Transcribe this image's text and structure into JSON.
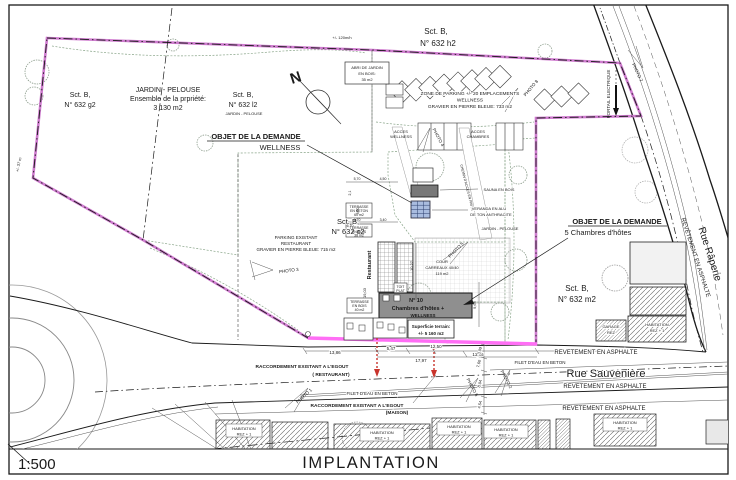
{
  "meta": {
    "scale": "1:500",
    "title": "IMPLANTATION"
  },
  "colors": {
    "green": "#d8edd4",
    "magenta_boundary": "#cf7bcf",
    "magenta_bright": "#ff6ef5",
    "red_sewer": "#c9342c",
    "veranda_blue": "#a9bcdf",
    "building_gray": "#8f8f8f"
  },
  "compass": {
    "north": "N"
  },
  "parcels": {
    "sct": "Sct. B,",
    "g2": "N° 632 g2",
    "l2": "N° 632 l2",
    "l2_type": "JARDIN - PELOUSE",
    "h2": "N° 632 h2",
    "c2": "N° 632 c2",
    "m2": "N° 632 m2"
  },
  "garden": {
    "l1": "JARDIN - PELOUSE",
    "l2": "Ensemble de la prpriété:",
    "l3": "3 130 m2",
    "length_note": "+/- 120m/h",
    "width_note": "+/- 37 m"
  },
  "abri": {
    "l1": "ABRI DE JARDIN",
    "l2": "EN BOIS:",
    "l3": "35 m2"
  },
  "parking_wellness": {
    "l1": "ZONE DE PARKING +/- 20 EMPLACEMENTS",
    "l2": "WELLNESS",
    "l3": "GRAVIER EN PIERRE BLEUE: 733 m2"
  },
  "parking_restaurant": {
    "l1": "PARKING EXISTANT",
    "l2": "RESTAURANT",
    "l3": "GRAVIER EN PIERRE BLEUE: 715 m2"
  },
  "objet_wellness": {
    "l1": "OBJET DE LA DEMANDE",
    "l2": "WELLNESS"
  },
  "objet_chambres": {
    "l1": "OBJET DE LA DEMANDE",
    "l2": "5 Chambres d'hôtes"
  },
  "access": {
    "acces": "ACCES",
    "wellness": "WELLNESS",
    "chambres": "CHAMBRES"
  },
  "features": {
    "portail": "PORTAIL ELECTRIQUE",
    "chemin": "CHEMIN D'ACCES EN PAVES",
    "sauna": "SAUNA EN BOIS",
    "veranda_l1": "VERANDA EN ALU",
    "veranda_l2": "DE TON ANTHRACITE",
    "jardin": "JARDIN - PELOUSE",
    "cour_l1": "COUR",
    "cour_l2": "CARREAUX 40/40",
    "cour_l3": "119 m2",
    "toit_l1": "TOIT",
    "toit_l2": "PLAT",
    "restaurant": "Restaurant"
  },
  "building": {
    "n10": "N° 10",
    "name": "Chambres d'hôtes +",
    "suffix": "WELLNESS",
    "sup_l1": "Superficie terrain:",
    "sup_l2": "+/- 5 160 m2"
  },
  "terraces": {
    "terrasse": "TERRASSE",
    "beton": "EN BETON",
    "bois": "EN BOIS",
    "a60": "60 m2",
    "a38": "38 m2",
    "a40": "40 m2"
  },
  "roads": {
    "sauveniere": "Rue Sauvenière",
    "raperie": "Rue Râperie",
    "revetement": "REVETEMENT EN ASPHALTE",
    "revetement_v": "REVÊTEMENT EN ASPHALTE",
    "filet": "FILET D'EAU EN BETON"
  },
  "sewer": {
    "l1": "RACCORDEMENT EXISTANT A L'EGOUT",
    "restaurant": "( RESTAURANT)",
    "maison": "(MAISON)"
  },
  "houses": {
    "habitation": "HABITATION",
    "rez1": "REZ + 1",
    "garage": "GARAGE",
    "rez": "REZ"
  },
  "photos": {
    "p1": "PHOTO 1",
    "p2": "PHOTO 2",
    "p3": "PHOTO 3",
    "p4": "PHOTO 4",
    "p5": "PHOTO 5",
    "p6": "PHOTO 6",
    "p7": "PHOTO 7",
    "p8": "PHOTO 8"
  },
  "dims": {
    "d1386": "13,86",
    "d547": "5,47",
    "d1250": "12,50",
    "d1797": "17,97",
    "d1305": "13,05",
    "d309": "3,09",
    "d760": "7,60",
    "d804": "8,04",
    "d454": "4,54",
    "d1027": "10,27",
    "d965": "9,65",
    "d1903": "19,03",
    "d570": "5,70",
    "d450": "4,50",
    "d300": "3,00",
    "d340": "3,40",
    "d670": "6,70",
    "d21": "2,1"
  }
}
